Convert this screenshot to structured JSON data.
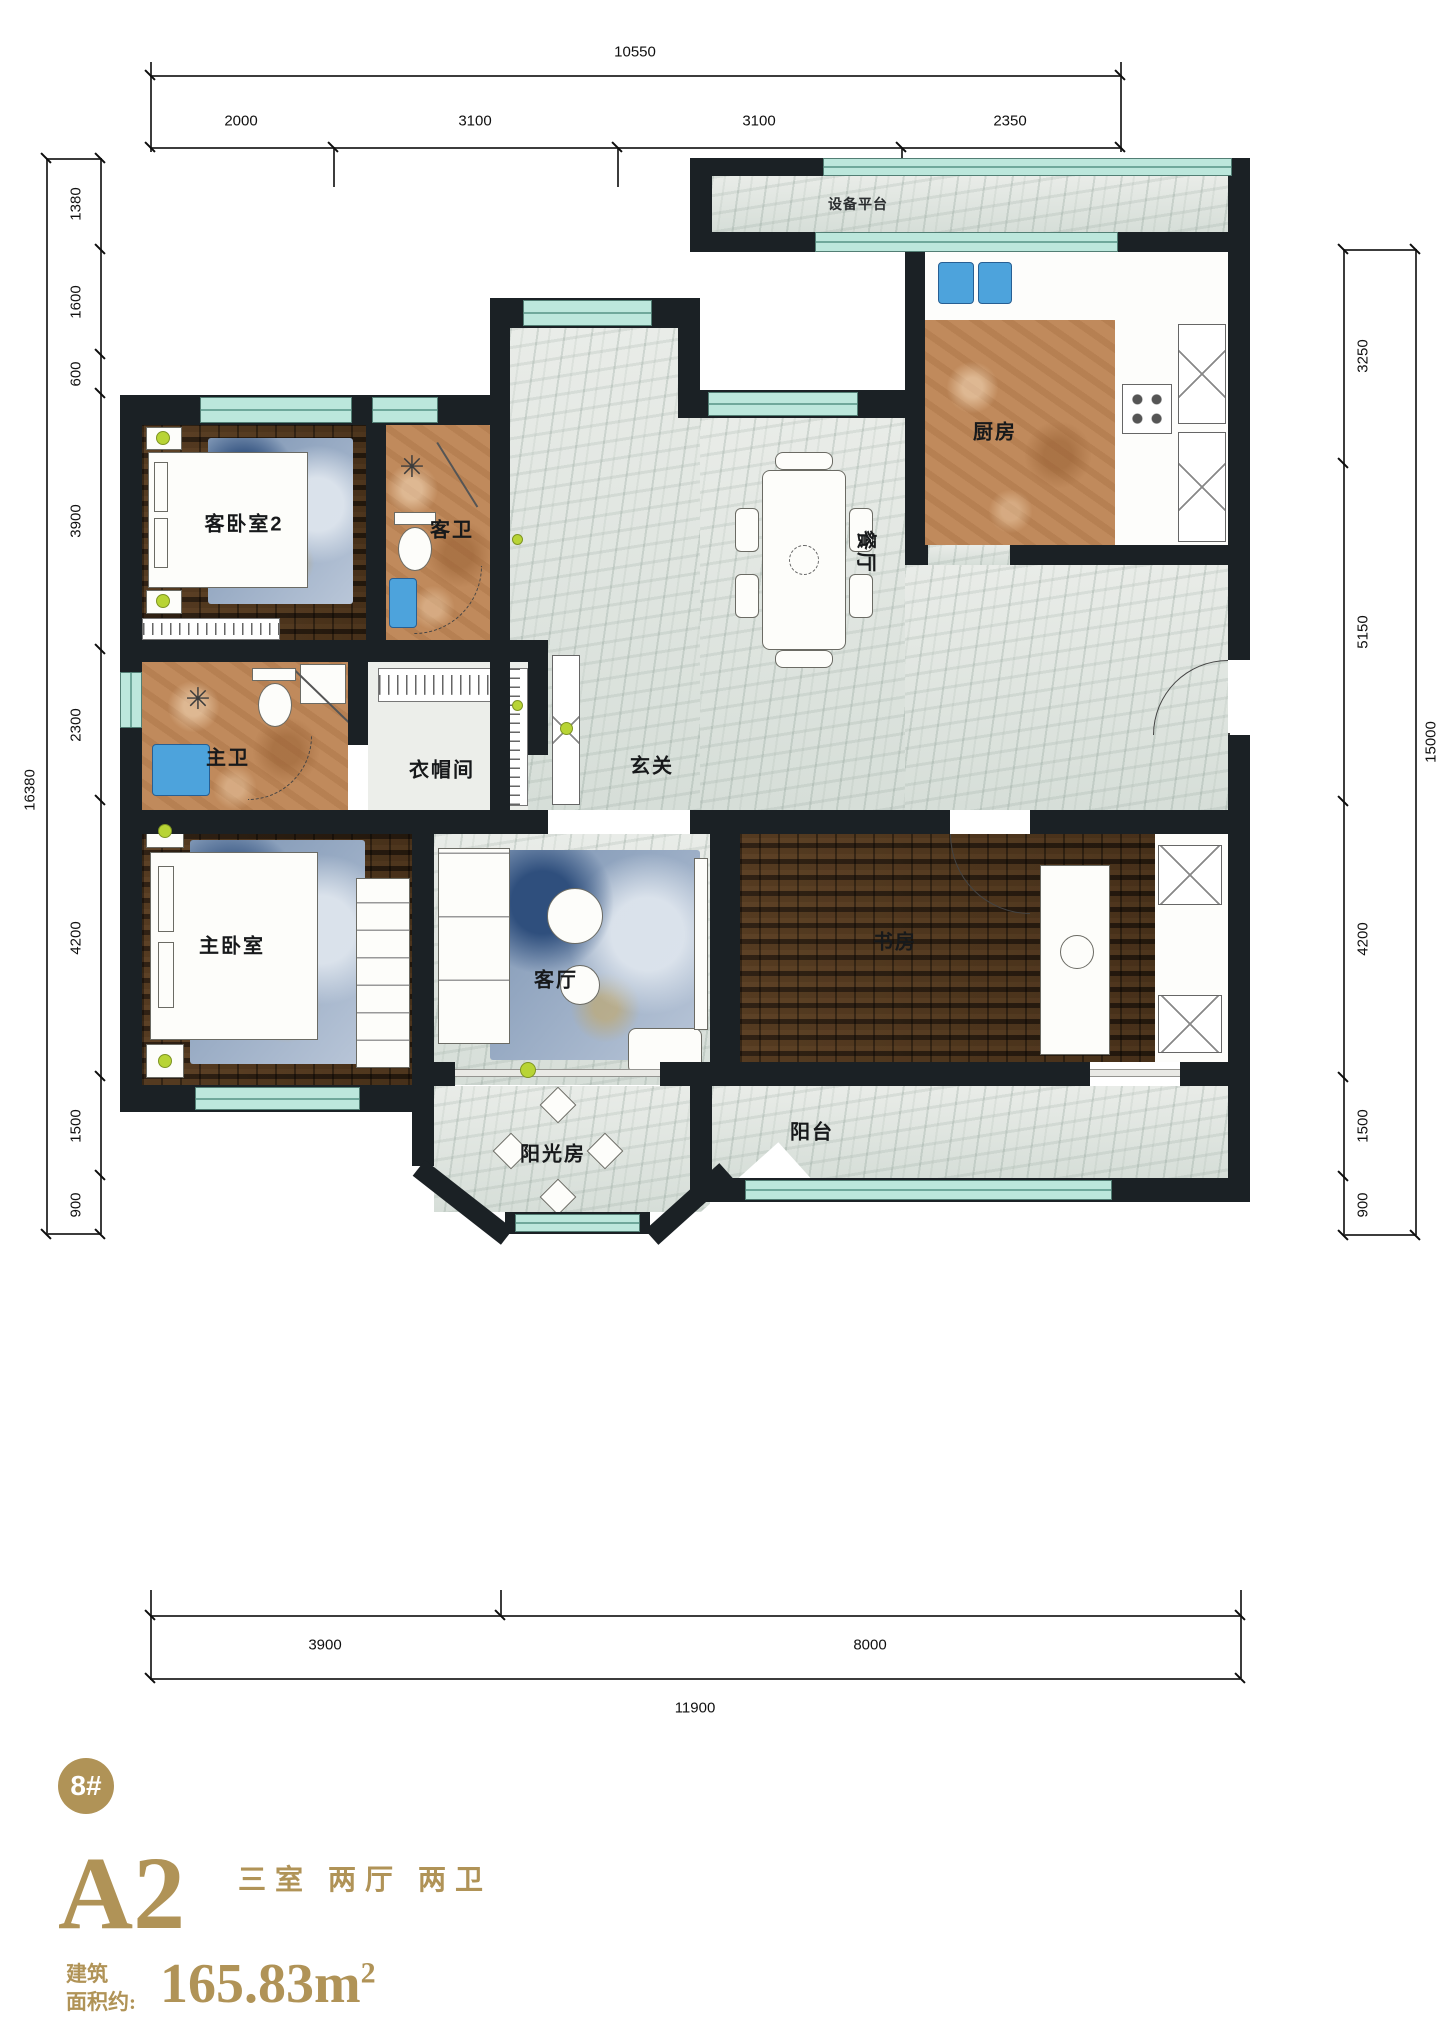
{
  "plan": {
    "rooms": {
      "equipment_platform": "设备平台",
      "kitchen": "厨房",
      "dining": "餐厅",
      "guest_bedroom2": "客卧室2",
      "guest_bath": "客卫",
      "master_bath": "主卫",
      "cloakroom": "衣帽间",
      "foyer": "玄关",
      "master_bedroom": "主卧室",
      "living_room": "客厅",
      "study": "书房",
      "sunroom": "阳光房",
      "balcony": "阳台"
    },
    "dims": {
      "top": {
        "total": "10550",
        "segments": [
          "2000",
          "3100",
          "3100",
          "2350"
        ]
      },
      "left": {
        "total": "16380",
        "segments": [
          "1380",
          "1600",
          "600",
          "3900",
          "2300",
          "4200",
          "1500",
          "900"
        ]
      },
      "right": {
        "total": "15000",
        "segments": [
          "3250",
          "5150",
          "4200",
          "1500",
          "900"
        ]
      },
      "bottom": {
        "total": "11900",
        "segments": [
          "3900",
          "8000"
        ]
      }
    },
    "icons": {
      "shower": "✳"
    }
  },
  "footer": {
    "building_badge": "8#",
    "unit_name": "A2",
    "layout_desc": "三室 两厅 两卫",
    "area_label_line1": "建筑",
    "area_label_line2": "面积约:",
    "area_value": "165.83m",
    "area_exponent": "2"
  },
  "colors": {
    "accent_gold": "#b09357",
    "wall": "#1b2125",
    "window_teal": "#bce7dc",
    "wood_floor": "#3d2d1b",
    "terracotta_floor": "#c08a5c",
    "marble_floor": "#e0e6e1",
    "fixture_blue": "#4da3dc",
    "plant_lime": "#b8d435"
  }
}
